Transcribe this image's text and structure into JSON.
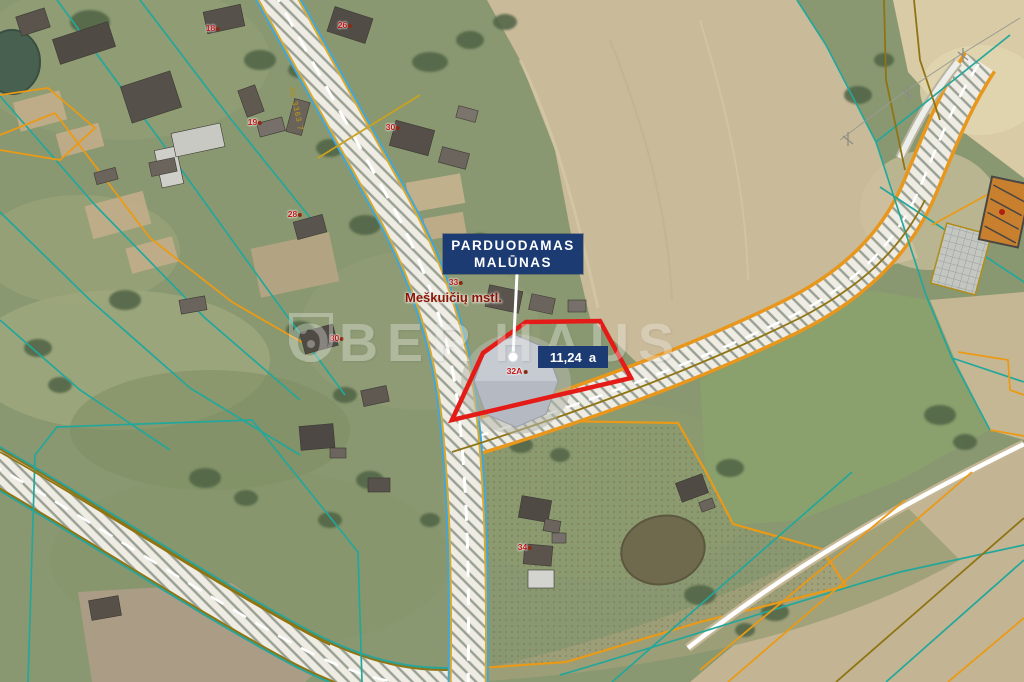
{
  "labels": {
    "for_sale_line1": "PARDUODAMAS",
    "for_sale_line2": "MALŪNAS",
    "area": "11,24  a",
    "place": "Meškuičių mstl.",
    "road_code": "4b 3363 7"
  },
  "watermark": {
    "left": "OBER",
    "right": "HAUS"
  },
  "house_numbers": [
    {
      "text": "18",
      "x": 213,
      "y": 28
    },
    {
      "text": "26",
      "x": 345,
      "y": 25
    },
    {
      "text": "19",
      "x": 255,
      "y": 122
    },
    {
      "text": "30",
      "x": 393,
      "y": 127
    },
    {
      "text": "28",
      "x": 295,
      "y": 214
    },
    {
      "text": "33",
      "x": 456,
      "y": 282
    },
    {
      "text": "30",
      "x": 337,
      "y": 338
    },
    {
      "text": "32A",
      "x": 517,
      "y": 371
    },
    {
      "text": "34",
      "x": 525,
      "y": 547
    }
  ],
  "colors": {
    "label_bg": "#1c3b72",
    "label_text": "#ffffff",
    "property_outline": "#e41b17",
    "place_text": "#8a1408",
    "house_number_text": "#c01818",
    "cadastral_teal": "#23a79b",
    "cadastral_blue": "#3fa7e0",
    "cadastral_orange": "#ea9a16",
    "cadastral_olive": "#8f7413",
    "road_fill": "#efece4"
  }
}
